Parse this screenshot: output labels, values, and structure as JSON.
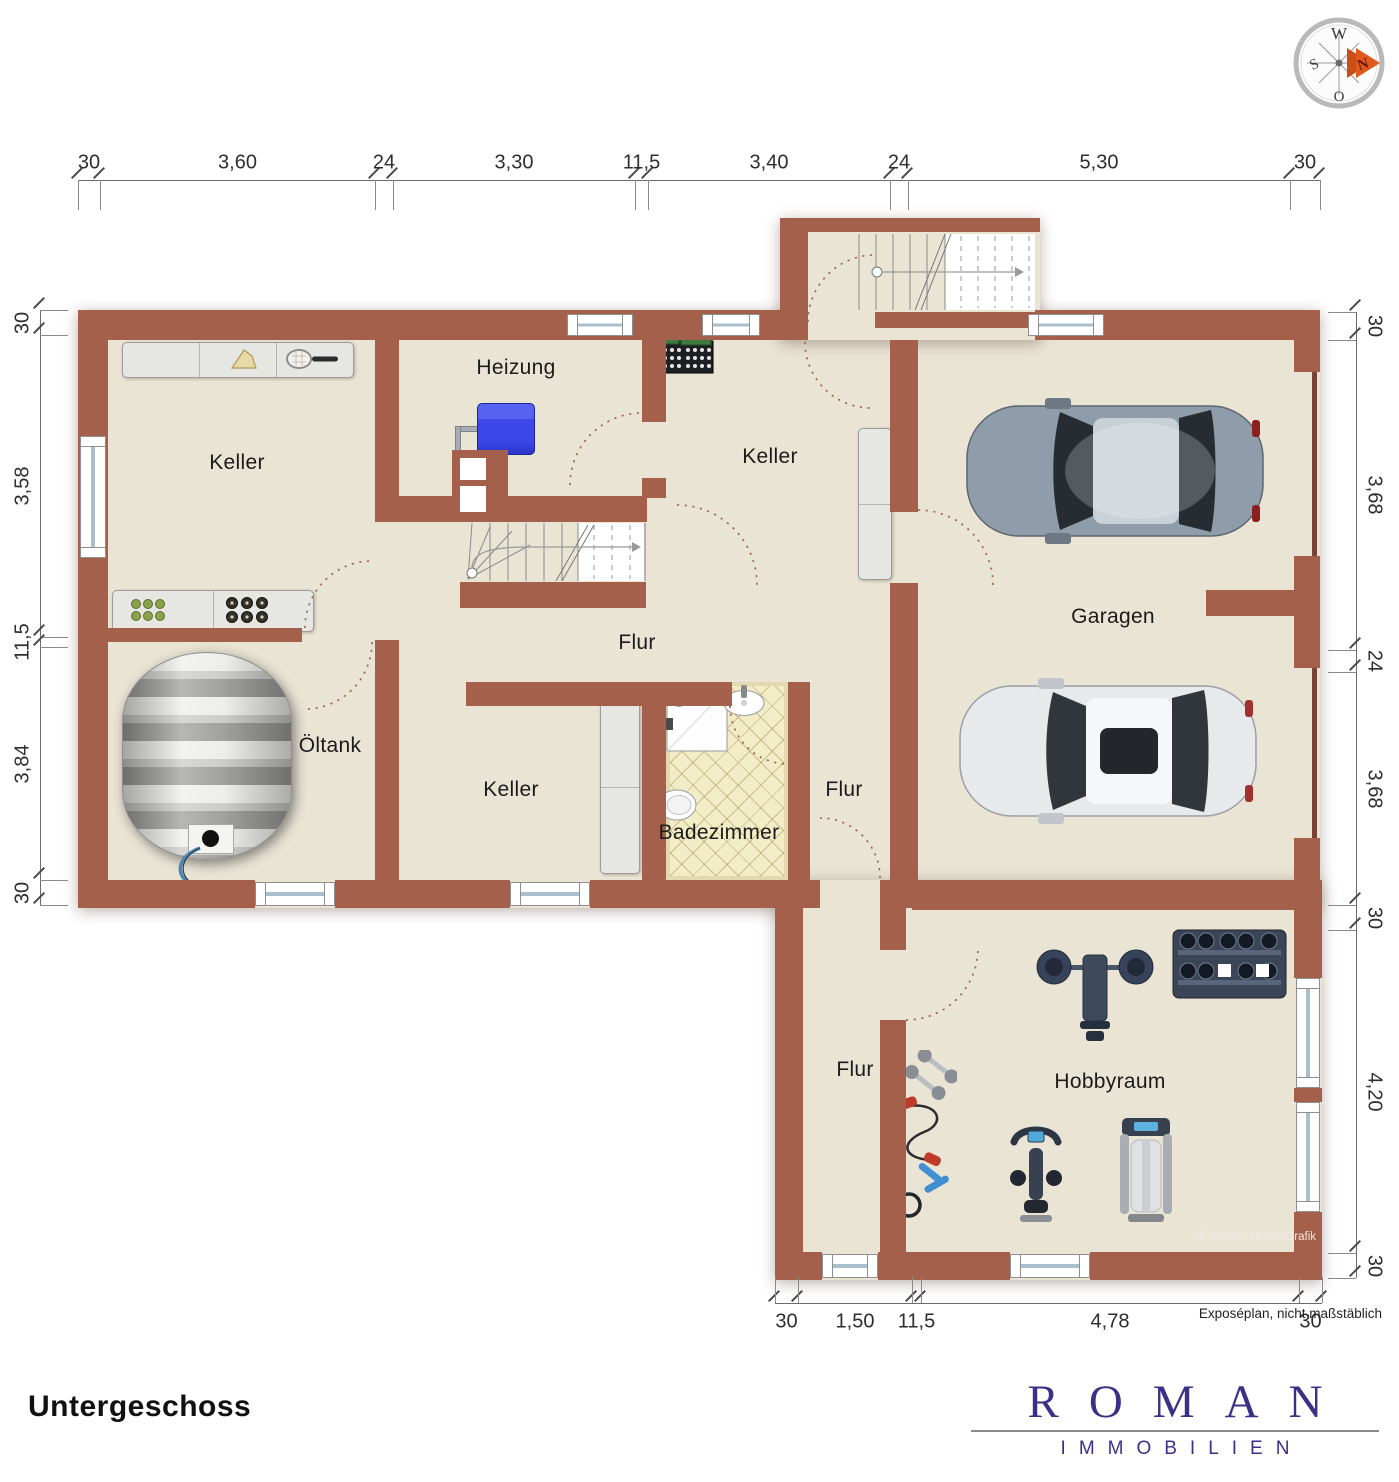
{
  "meta": {
    "floor_title": "Untergeschoss",
    "disclaimer": "Exposéplan, nicht maßstäblich",
    "credit": "illustration©immoGrafik"
  },
  "logo": {
    "name": "ROMAN",
    "subtitle": "IMMOBILIEN"
  },
  "compass": {
    "west": "W",
    "south": "S",
    "east": "O",
    "north": "N"
  },
  "rooms": {
    "keller_top_left": {
      "label": "Keller"
    },
    "heizung": {
      "label": "Heizung"
    },
    "keller_top_middle": {
      "label": "Keller"
    },
    "garage": {
      "label": "Garagen"
    },
    "oeltank": {
      "label": "Öltank"
    },
    "flur_middle": {
      "label": "Flur"
    },
    "keller_bottom": {
      "label": "Keller"
    },
    "badezimmer": {
      "label": "Badezimmer"
    },
    "flur_small": {
      "label": "Flur"
    },
    "flur_lower": {
      "label": "Flur"
    },
    "hobbyraum": {
      "label": "Hobbyraum"
    }
  },
  "dimensions": {
    "top": [
      "30",
      "3,60",
      "24",
      "3,30",
      "11,5",
      "3,40",
      "24",
      "5,30",
      "30"
    ],
    "left": [
      "30",
      "3,58",
      "11,5",
      "3,84",
      "30"
    ],
    "right": [
      "30",
      "3,68",
      "24",
      "3,68",
      "30",
      "4,20",
      "30"
    ],
    "bottom": [
      "30",
      "1,50",
      "11,5",
      "4,78",
      "30"
    ]
  },
  "colors": {
    "wall": "#A5604B",
    "wall_dark": "#7A4234",
    "floor": "#EAE4D5",
    "tile": "#F3EDC7",
    "boiler": "#3D47E8",
    "logo": "#3A3187",
    "accent_north": "#E05A1E"
  }
}
